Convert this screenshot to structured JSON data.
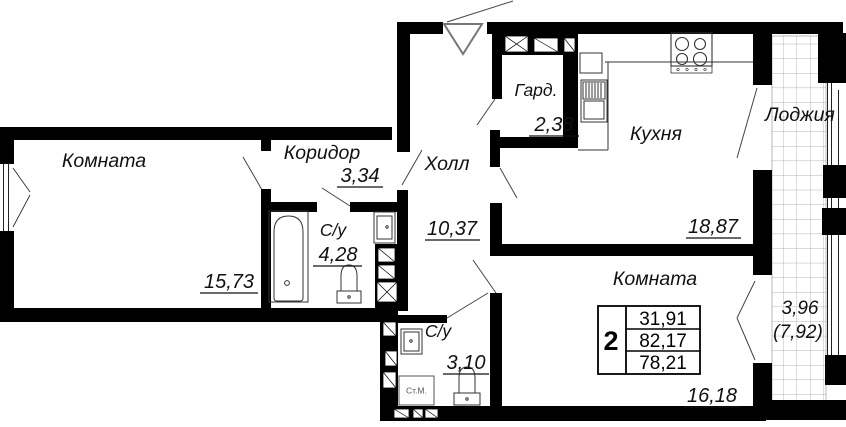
{
  "plan": {
    "title": "apartment-floor-plan",
    "rooms": [
      {
        "id": "room1",
        "name": "Комната",
        "area": "15,73"
      },
      {
        "id": "corridor",
        "name": "Коридор",
        "area": "3,34"
      },
      {
        "id": "hall",
        "name": "Холл",
        "area": "10,37"
      },
      {
        "id": "wardrobe",
        "name": "Гард.",
        "area": "2,38"
      },
      {
        "id": "kitchen",
        "name": "Кухня",
        "area": "18,87"
      },
      {
        "id": "bath1",
        "name": "С/у",
        "area": "4,28"
      },
      {
        "id": "bath2",
        "name": "С/у",
        "area": "3,10"
      },
      {
        "id": "room2",
        "name": "Комната",
        "area": "16,18"
      },
      {
        "id": "loggia",
        "name": "Лоджия",
        "area": "3,96",
        "area_coeff": "(7,92)"
      }
    ],
    "summary_table": {
      "rooms_count": "2",
      "living_area": "31,91",
      "total_area": "82,17",
      "reduced_area": "78,21"
    },
    "appliances": {
      "washing_machine": "Ст.М."
    },
    "icons": [
      "entrance-door-icon",
      "bathtub-icon",
      "toilet-icon",
      "sink-icon",
      "stove-icon",
      "kitchen-sink-icon",
      "washing-machine-icon",
      "wardrobe-shelf-icon",
      "loggia-tiles"
    ],
    "colors": {
      "wall": "#000000",
      "line": "#333333",
      "door_leaf": "#777777",
      "grid": "#9a9a9a",
      "background": "#ffffff"
    }
  }
}
